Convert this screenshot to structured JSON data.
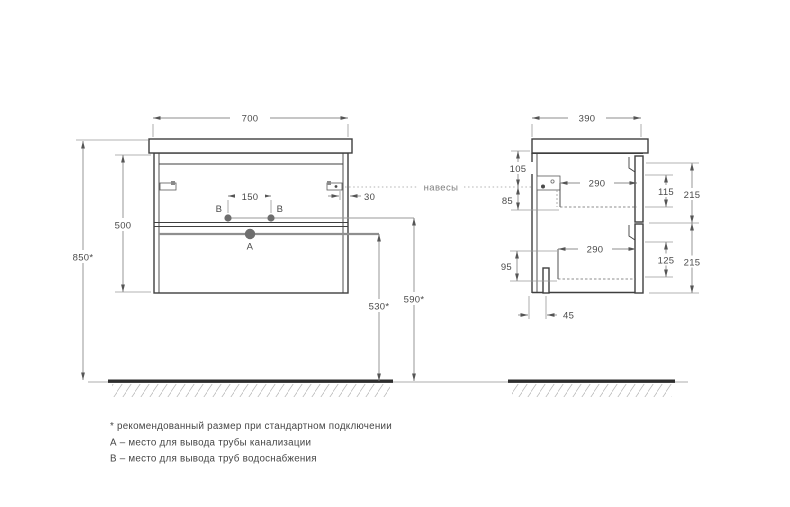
{
  "drawing": {
    "front_view": {
      "width": "700",
      "carcass_height": "500",
      "total_height": "850*",
      "supply_spacing": "150",
      "hanger_offset": "30",
      "point_a": "А",
      "point_b": "В",
      "drain_height": "530*",
      "supply_height": "590*"
    },
    "side_view": {
      "depth": "390",
      "hanger_top_offset": "105",
      "hanger_drop": "85",
      "bottom_offset": "95",
      "top_drawer_depth": "290",
      "bottom_drawer_depth": "290",
      "top_drawer_inner": "115",
      "bottom_drawer_inner": "125",
      "top_front_height": "215",
      "bottom_front_height": "215",
      "drain_back_offset": "45"
    },
    "annotations": {
      "hangers": "навесы",
      "footnote_1": "* рекомендованный размер при стандартном подключении",
      "footnote_2": "А – место для вывода трубы канализации",
      "footnote_3": "В – место для вывода труб водоснабжения"
    },
    "colors": {
      "outline": "#3f3f3f",
      "dimension": "#8c8c8c",
      "ground": "#2e2e2e",
      "point_fill": "#6e6e6e"
    }
  }
}
